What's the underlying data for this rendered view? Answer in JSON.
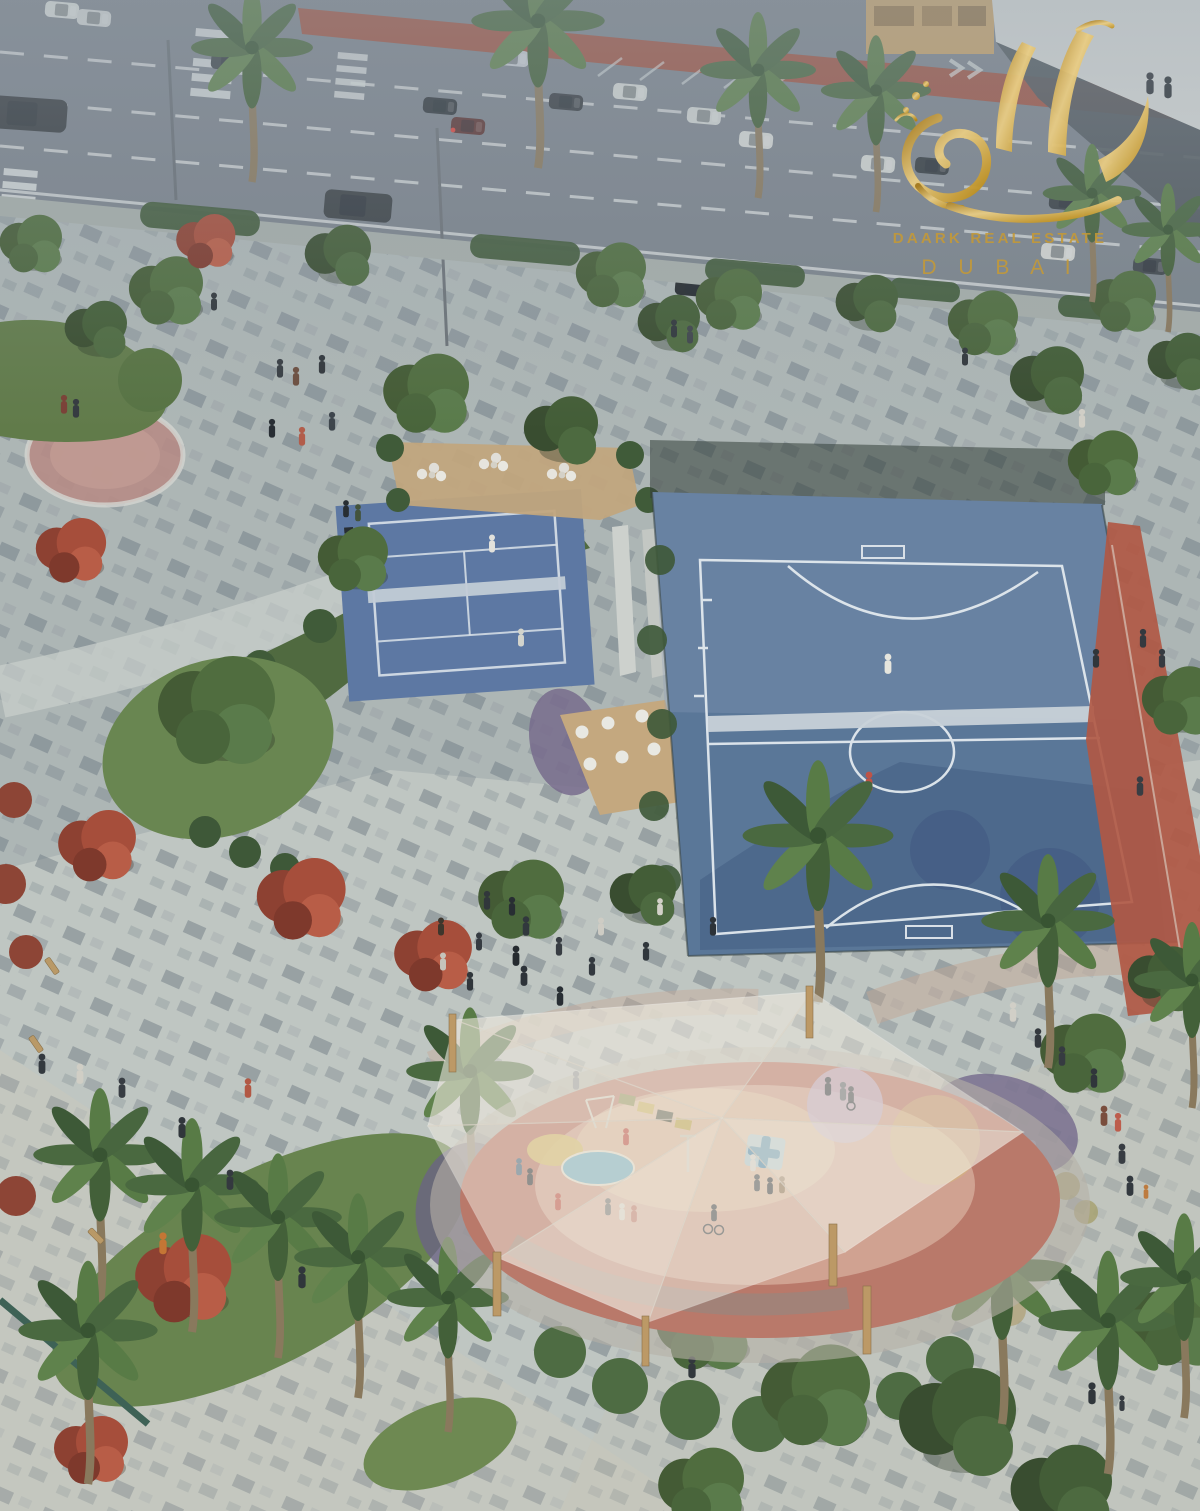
{
  "watermark": {
    "line1": "DAARK REAL ESTATE",
    "line2": "D U B A I",
    "gold": "#c9992e"
  },
  "scene": {
    "setting": "aerial rendering of a landscaped community park beside a road",
    "road": {
      "asphalt": "#7a828b",
      "bike_lane_red": "#a34a36",
      "marking_white": "#e8ebea"
    },
    "plaza": {
      "paving_light": "#c3c9c5",
      "paver_dark": "#6f7c84"
    },
    "padel_court": {
      "surface": "#5b76a4",
      "line": "#dfe7ee",
      "net": "#c6d0da"
    },
    "futsal_court": {
      "surface": "#587598",
      "line": "#e9eff5",
      "track_red": "#b35540"
    },
    "playground": {
      "rubber_red": "#bd7768",
      "canopy_fabric": "#f5efe3",
      "post_wood": "#c09a63",
      "splash_blue": "#7eb5c8",
      "splash_yellow": "#d9bf6a",
      "splash_lavender": "#c4b4d4"
    },
    "greens": {
      "lawn": "#68854d",
      "tree": "#4d6b3a",
      "flowering_red": "#a84a36",
      "palm": "#4c6a39"
    }
  }
}
